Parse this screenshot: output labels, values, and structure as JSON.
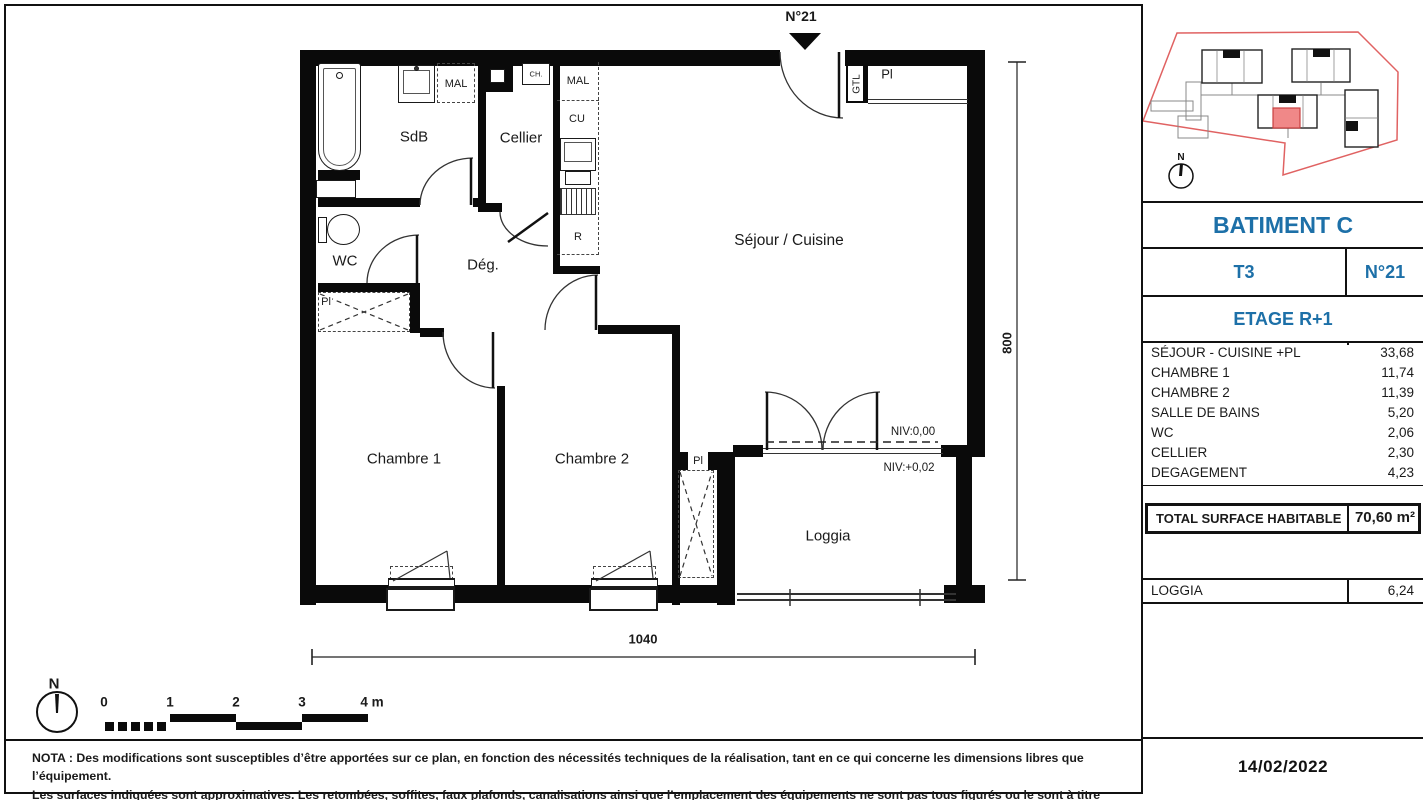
{
  "plan": {
    "entry_label": "N°21",
    "north_label": "N",
    "rooms": {
      "sdb": "SdB",
      "cellier": "Cellier",
      "wc": "WC",
      "degagement": "Dég.",
      "sejour_cuisine": "Séjour / Cuisine",
      "chambre1": "Chambre 1",
      "chambre2": "Chambre 2",
      "loggia": "Loggia"
    },
    "fixtures": {
      "mal_sdb": "MAL",
      "mal_cuisine": "MAL",
      "cu": "CU",
      "refrigerator": "R",
      "chauffe_eau": "CH.",
      "gtl": "GTL",
      "placard_entree": "Pl",
      "placard_chambre1": "Pl",
      "placard_chambre2": "Pl"
    },
    "levels": {
      "niv_interieur": "NIV:0,00",
      "niv_loggia": "NIV:+0,02"
    },
    "dimensions": {
      "height_cm": "800",
      "width_cm": "1040"
    },
    "scale_bar": {
      "ticks": [
        "0",
        "1",
        "2",
        "3",
        "4 m"
      ]
    }
  },
  "sidebar": {
    "north_label": "N",
    "building": "BATIMENT C",
    "apartment_type": "T3",
    "apartment_number": "N°21",
    "floor": "ETAGE R+1",
    "areas": [
      {
        "label": "SÉJOUR - CUISINE +PL",
        "value": "33,68"
      },
      {
        "label": "CHAMBRE 1",
        "value": "11,74"
      },
      {
        "label": "CHAMBRE 2",
        "value": "11,39"
      },
      {
        "label": "SALLE DE BAINS",
        "value": "5,20"
      },
      {
        "label": "WC",
        "value": "2,06"
      },
      {
        "label": "CELLIER",
        "value": "2,30"
      },
      {
        "label": "DEGAGEMENT",
        "value": "4,23"
      }
    ],
    "total_label": "TOTAL SURFACE HABITABLE",
    "total_value": "70,60 m²",
    "loggia_label": "LOGGIA",
    "loggia_value": "6,24",
    "date": "14/02/2022"
  },
  "nota": {
    "line1": "NOTA : Des modifications sont susceptibles d’être apportées sur ce plan, en fonction des nécessités techniques de la réalisation, tant en ce qui concerne les dimensions libres que l’équipement.",
    "line2": "Les surfaces indiquées sont approximatives. Les retombées, soffites, faux plafonds, canalisations ainsi que l’emplacement des équipements ne sont pas tous figurés ou le sont à titre indicatif."
  },
  "colors": {
    "accent_blue": "#1d70a8",
    "site_boundary_red": "#e06262",
    "highlight_unit_red": "#f08888"
  }
}
